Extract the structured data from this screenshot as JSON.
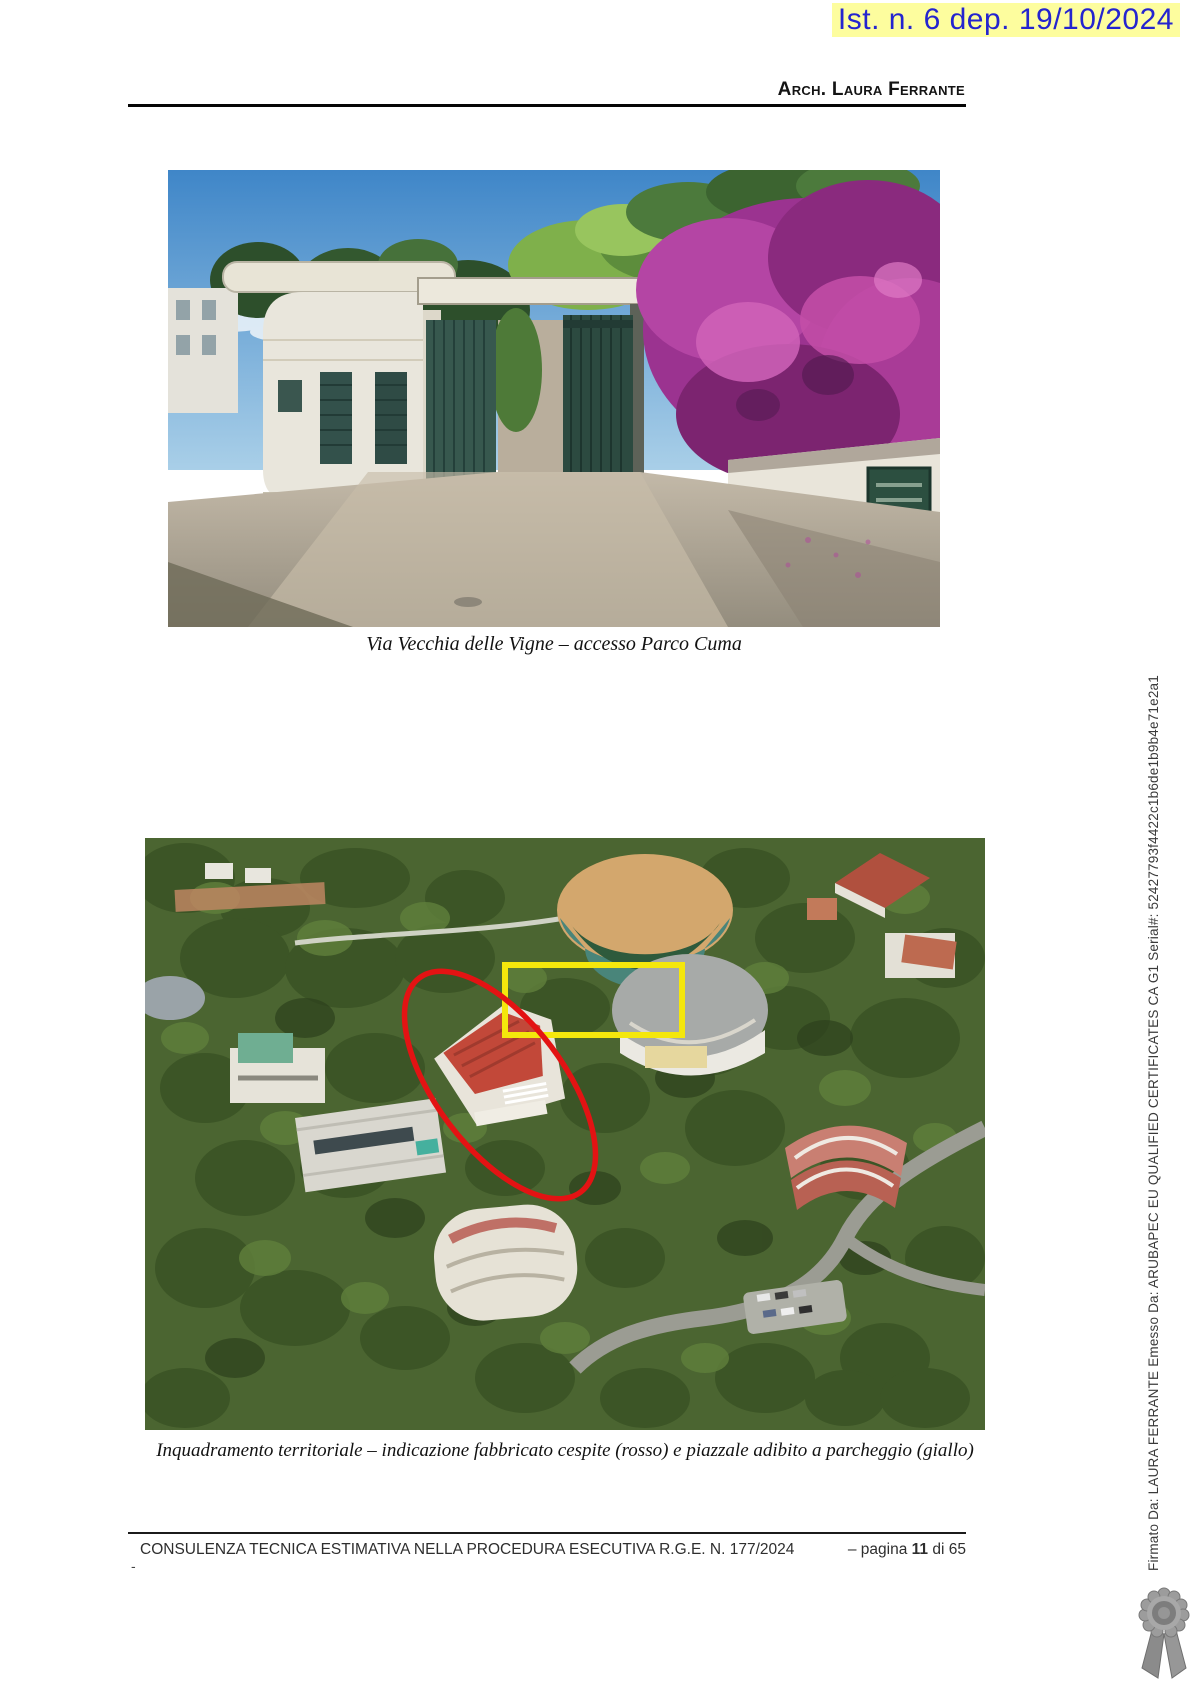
{
  "stamp": {
    "text": "Ist. n. 6 dep. 19/10/2024",
    "text_color": "#2424cf",
    "highlight_color": "#fdfd9e"
  },
  "header": {
    "author": "Arch. Laura Ferrante"
  },
  "figures": [
    {
      "caption": "Via Vecchia delle Vigne – accesso Parco Cuma"
    },
    {
      "caption": "Inquadramento territoriale – indicazione fabbricato cespite (rosso) e piazzale adibito a parcheggio (giallo)",
      "annotation_colors": {
        "building_ellipse": "#e31313",
        "parking_rect": "#f4e70c"
      }
    }
  ],
  "footer": {
    "report_title": "CONSULENZA TECNICA ESTIMATIVA NELLA PROCEDURA ESECUTIVA R.G.E. N. 177/2024",
    "page_prefix": "– pagina",
    "page_number": "11",
    "page_suffix": "di 65",
    "stray_mark": "-"
  },
  "signature_sidebar": {
    "text": "Firmato Da: LAURA FERRANTE Emesso Da: ARUBAPEC EU QUALIFIED CERTIFICATES CA G1 Serial#: 52427793f4422c1b6de1b9b4e71e2a1"
  }
}
